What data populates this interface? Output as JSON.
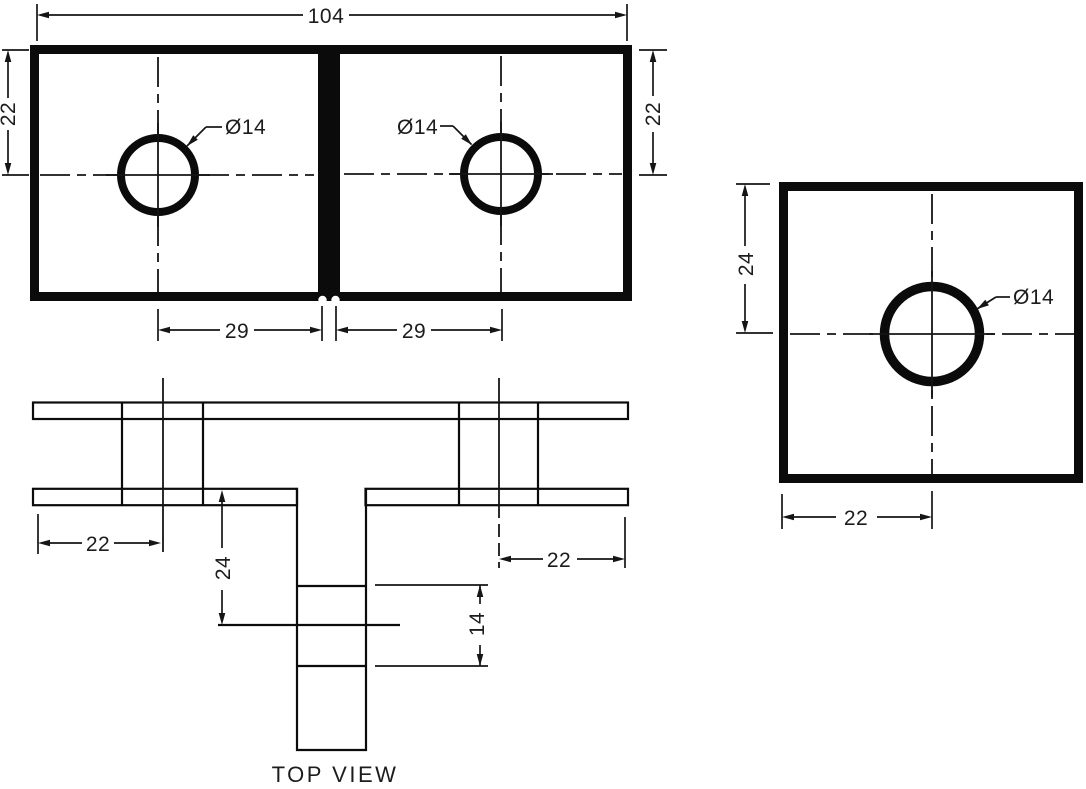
{
  "colors": {
    "plate_fill": "#dde3e9",
    "line": "#0b0b0b",
    "background": "#ffffff"
  },
  "front_view": {
    "dim_overall_width": "104",
    "dim_height_left": "22",
    "dim_height_right": "22",
    "dim_hole_center_left": "29",
    "dim_hole_center_right": "29",
    "hole_label_left": "Ø14",
    "hole_label_right": "Ø14"
  },
  "side_view": {
    "dim_center_from_top": "24",
    "dim_center_from_left": "22",
    "hole_label": "Ø14"
  },
  "top_view": {
    "title": "TOP VIEW",
    "dim_left_tab": "22",
    "dim_right_tab": "22",
    "dim_stem_depth": "24",
    "dim_stem_hole_width": "14"
  }
}
